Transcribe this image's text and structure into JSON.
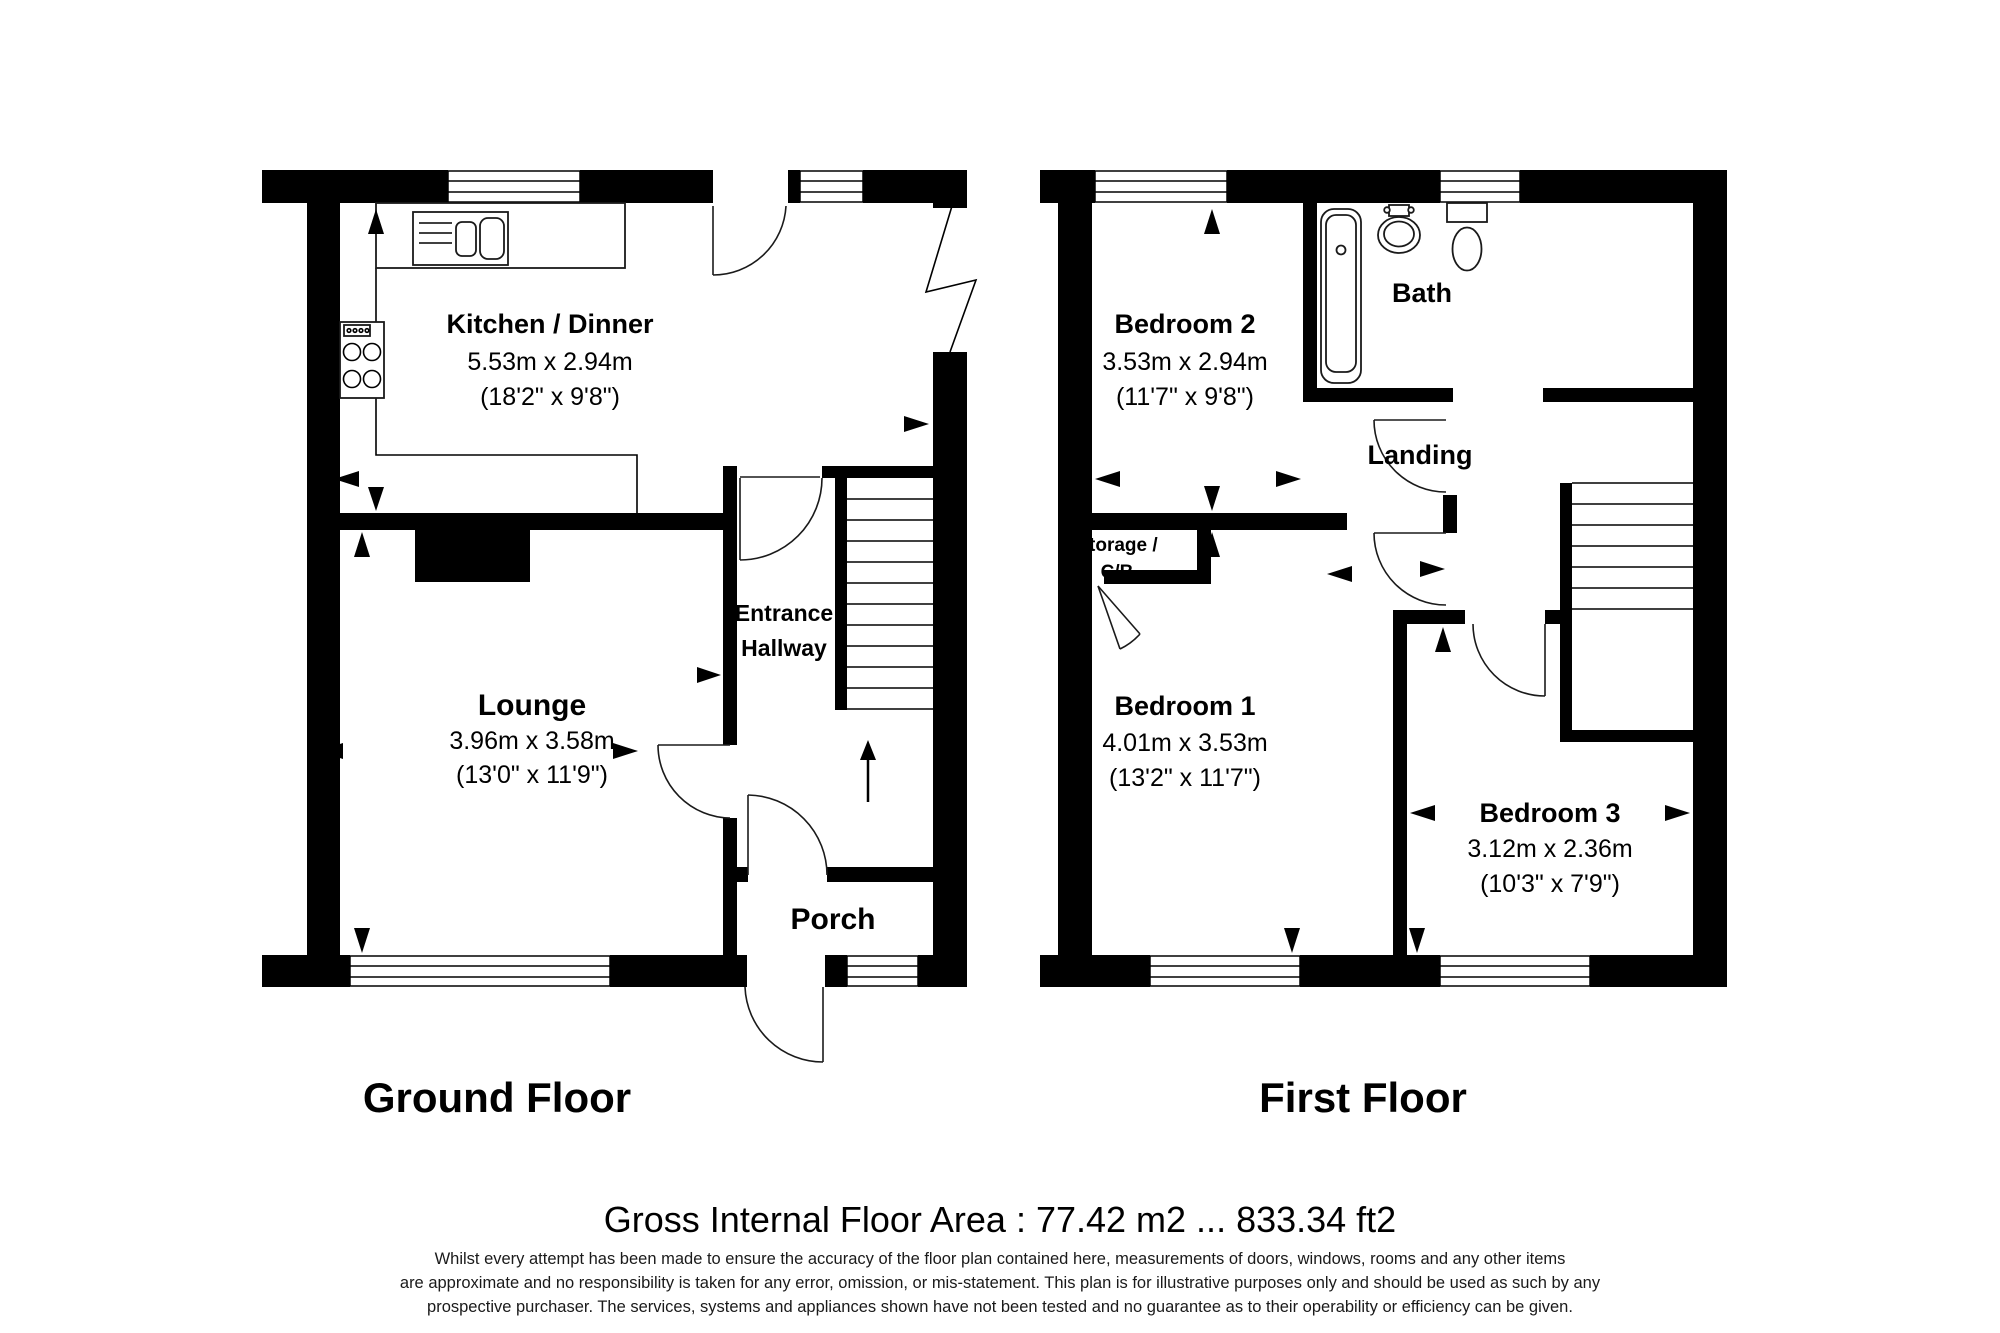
{
  "document": {
    "type": "floorplan",
    "background": "#ffffff",
    "wall_color": "#000000",
    "line_color": "#1a1a1a"
  },
  "floors": {
    "ground": {
      "title": "Ground Floor"
    },
    "first": {
      "title": "First Floor"
    }
  },
  "rooms": {
    "kitchen": {
      "name": "Kitchen / Dinner",
      "metric": "5.53m x 2.94m",
      "imperial": "(18'2\" x 9'8\")"
    },
    "lounge": {
      "name": "Lounge",
      "metric": "3.96m x 3.58m",
      "imperial": "(13'0\" x 11'9\")"
    },
    "hallway": {
      "name_line1": "Entrance",
      "name_line2": "Hallway"
    },
    "porch": {
      "name": "Porch"
    },
    "bedroom2": {
      "name": "Bedroom 2",
      "metric": "3.53m x 2.94m",
      "imperial": "(11'7\" x 9'8\")"
    },
    "bath": {
      "name": "Bath"
    },
    "landing": {
      "name": "Landing"
    },
    "storage": {
      "name_line1": "Storage /",
      "name_line2": "C/B"
    },
    "bedroom1": {
      "name": "Bedroom 1",
      "metric": "4.01m x 3.53m",
      "imperial": "(13'2\" x 11'7\")"
    },
    "bedroom3": {
      "name": "Bedroom 3",
      "metric": "3.12m x 2.36m",
      "imperial": "(10'3\" x 7'9\")"
    }
  },
  "footer": {
    "area_line": "Gross Internal Floor Area : 77.42 m2 ... 833.34 ft2",
    "disclaimer_line1": "Whilst every attempt has been made to ensure the accuracy of the floor plan contained here, measurements of doors, windows, rooms and any other items",
    "disclaimer_line2": "are approximate and no responsibility is taken for any error, omission, or mis-statement. This plan is for illustrative purposes only and should be used as such by any",
    "disclaimer_line3": "prospective purchaser. The services, systems and appliances shown have not been tested and no guarantee as to their operability or efficiency can be given."
  }
}
